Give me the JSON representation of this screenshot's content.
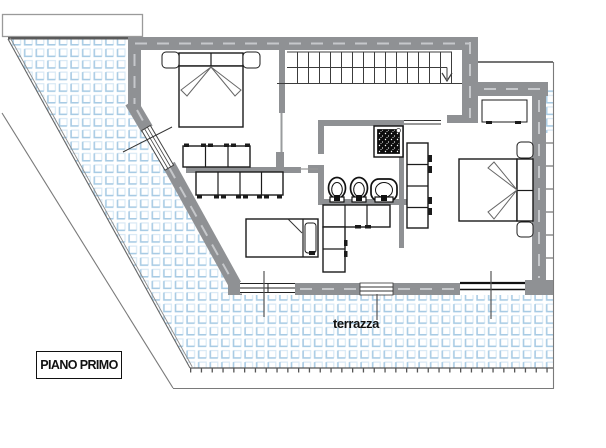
{
  "labels": {
    "floor": "PIANO PRIMO",
    "terrace": "terrazza"
  },
  "colors": {
    "wall-gray": "#8f9194",
    "wall-dash": "#c6c8cb",
    "tile-strong": "#a8cbe4",
    "tile-light": "#d9e9f5",
    "line-dark": "#1b1b1b",
    "outline-gray": "#7a7a7a"
  }
}
